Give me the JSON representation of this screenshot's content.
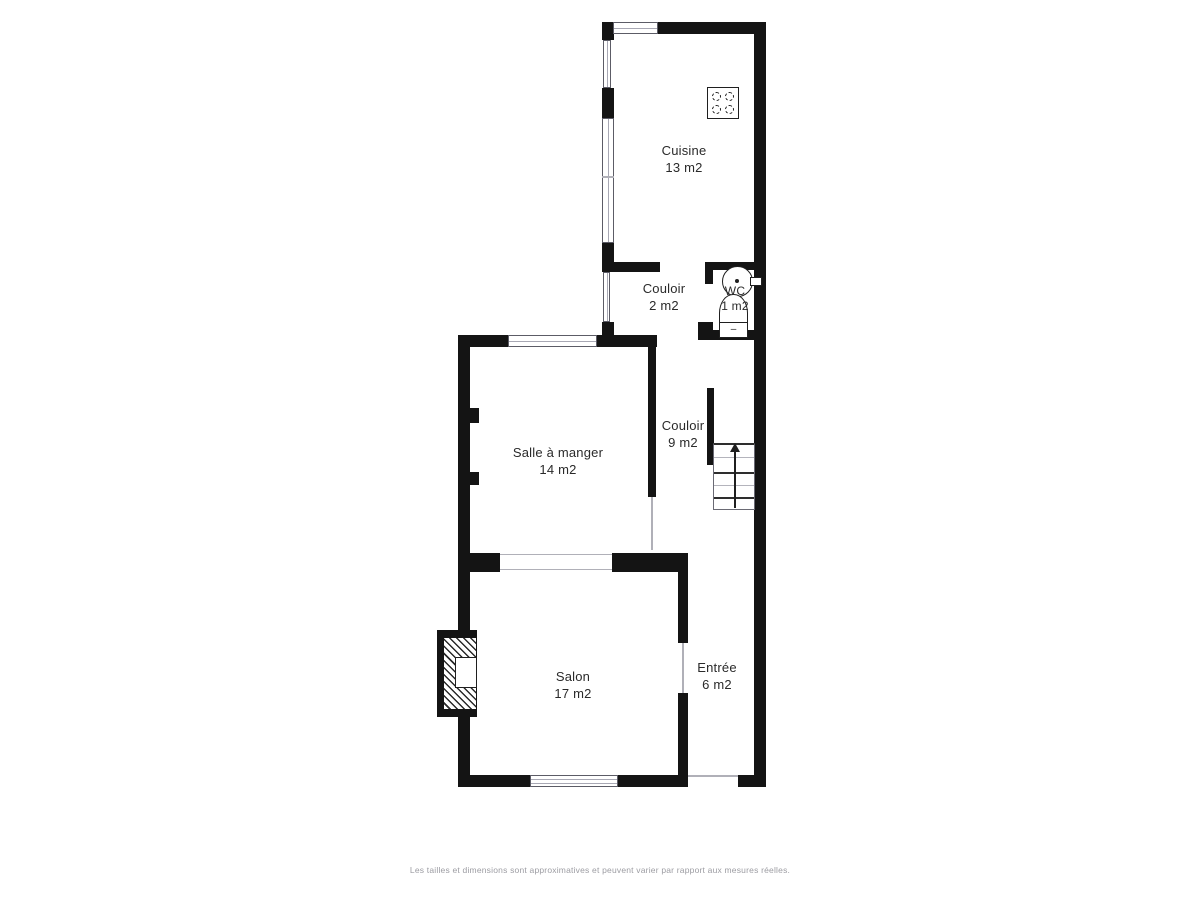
{
  "plan": {
    "rooms": [
      {
        "id": "cuisine",
        "name": "Cuisine",
        "area": "13 m2"
      },
      {
        "id": "couloir-2",
        "name": "Couloir",
        "area": "2 m2"
      },
      {
        "id": "wc",
        "name": "WC",
        "area": "1 m2"
      },
      {
        "id": "salle-a-manger",
        "name": "Salle à manger",
        "area": "14 m2"
      },
      {
        "id": "couloir-9",
        "name": "Couloir",
        "area": "9 m2"
      },
      {
        "id": "salon",
        "name": "Salon",
        "area": "17 m2"
      },
      {
        "id": "entree",
        "name": "Entrée",
        "area": "6 m2"
      }
    ],
    "fixtures": {
      "toilet_flush_mark": "–",
      "icons": [
        "stove-icon",
        "sink-icon",
        "toilet-icon",
        "stairs-icon",
        "stairs-up-arrow-icon",
        "fireplace-icon",
        "window-icon",
        "radiator-icon"
      ]
    },
    "colors": {
      "wall": "#141414",
      "background": "#ffffff",
      "window_line": "#a8a8b4",
      "label_text": "#2a2a2a",
      "disclaimer_text": "#9c9ca2"
    },
    "disclaimer": "Les tailles et dimensions sont approximatives et peuvent varier par rapport aux mesures réelles."
  }
}
